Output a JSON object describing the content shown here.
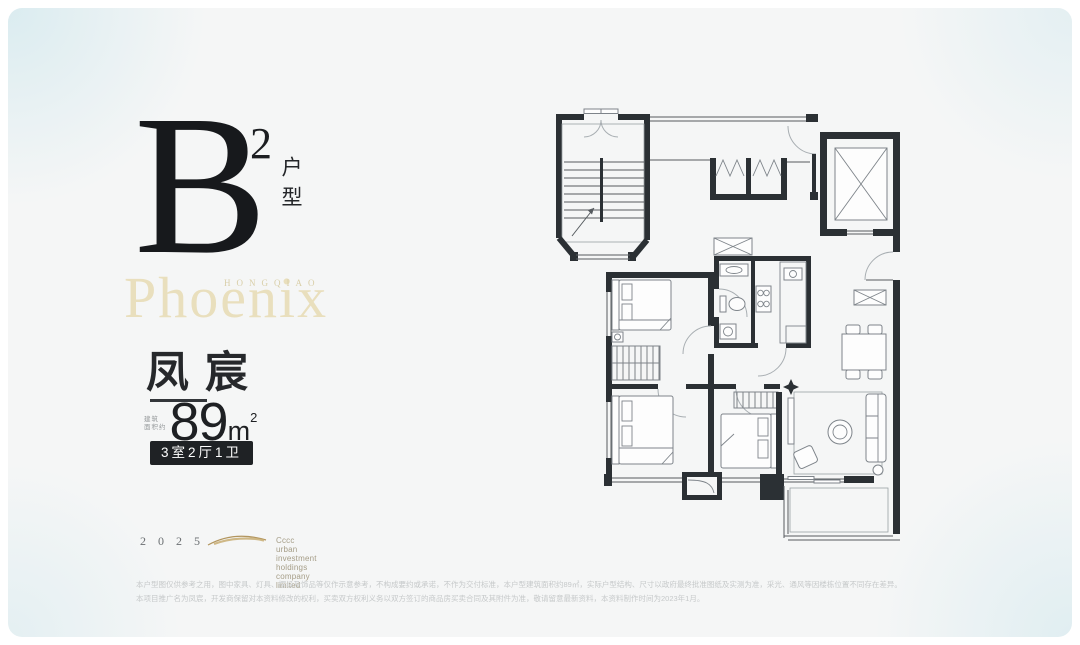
{
  "page": {
    "background": "#f5f6f6",
    "frame": "#ffffff",
    "corner_tint": "#96d2e1"
  },
  "unit": {
    "letter": "B",
    "sup": "2",
    "type_vertical": "户型"
  },
  "brand": {
    "en_small": "HONGQIAO",
    "en": "Phoenix",
    "cn": "凤宸",
    "gold": "#e9dfbd",
    "gold_dark": "#b2955e",
    "ink": "#26282b"
  },
  "area": {
    "prefix_line1": "建筑",
    "prefix_line2": "面积约",
    "value": "89",
    "unit": "m",
    "sup": "2"
  },
  "badge": {
    "text": "3室2厅1卫",
    "bg": "#1f2225",
    "fg": "#ffffff"
  },
  "footer": {
    "year": "2025",
    "company": "Cccc urban investment holdings company limited"
  },
  "disclaimer": {
    "line1": "本户型图仅供参考之用，图中家具、灯具、摆设及饰品等仅作示意参考，不构成要约或承诺，不作为交付标准，本户型建筑面积约89㎡，实际户型结构、尺寸以政府最终批准图纸及实测为准，采光、通风等因楼栋位置不同存在差异。",
    "line2": "本项目推广名为凤宸，开发商保留对本资料修改的权利，买卖双方权利义务以双方签订的商品房买卖合同及其附件为准，敬请留意最新资料，本资料制作时间为2023年1月。"
  },
  "floorplan": {
    "wall_color": "#2b3034",
    "line_color": "#565b5f",
    "furniture_stroke": "#7e848a",
    "rooms": [
      "stairwell",
      "elevator",
      "flue-shafts",
      "entry-foyer",
      "bathroom",
      "kitchen",
      "dining-area",
      "living-room",
      "bedroom-1",
      "bedroom-2",
      "bedroom-3",
      "balcony"
    ]
  }
}
